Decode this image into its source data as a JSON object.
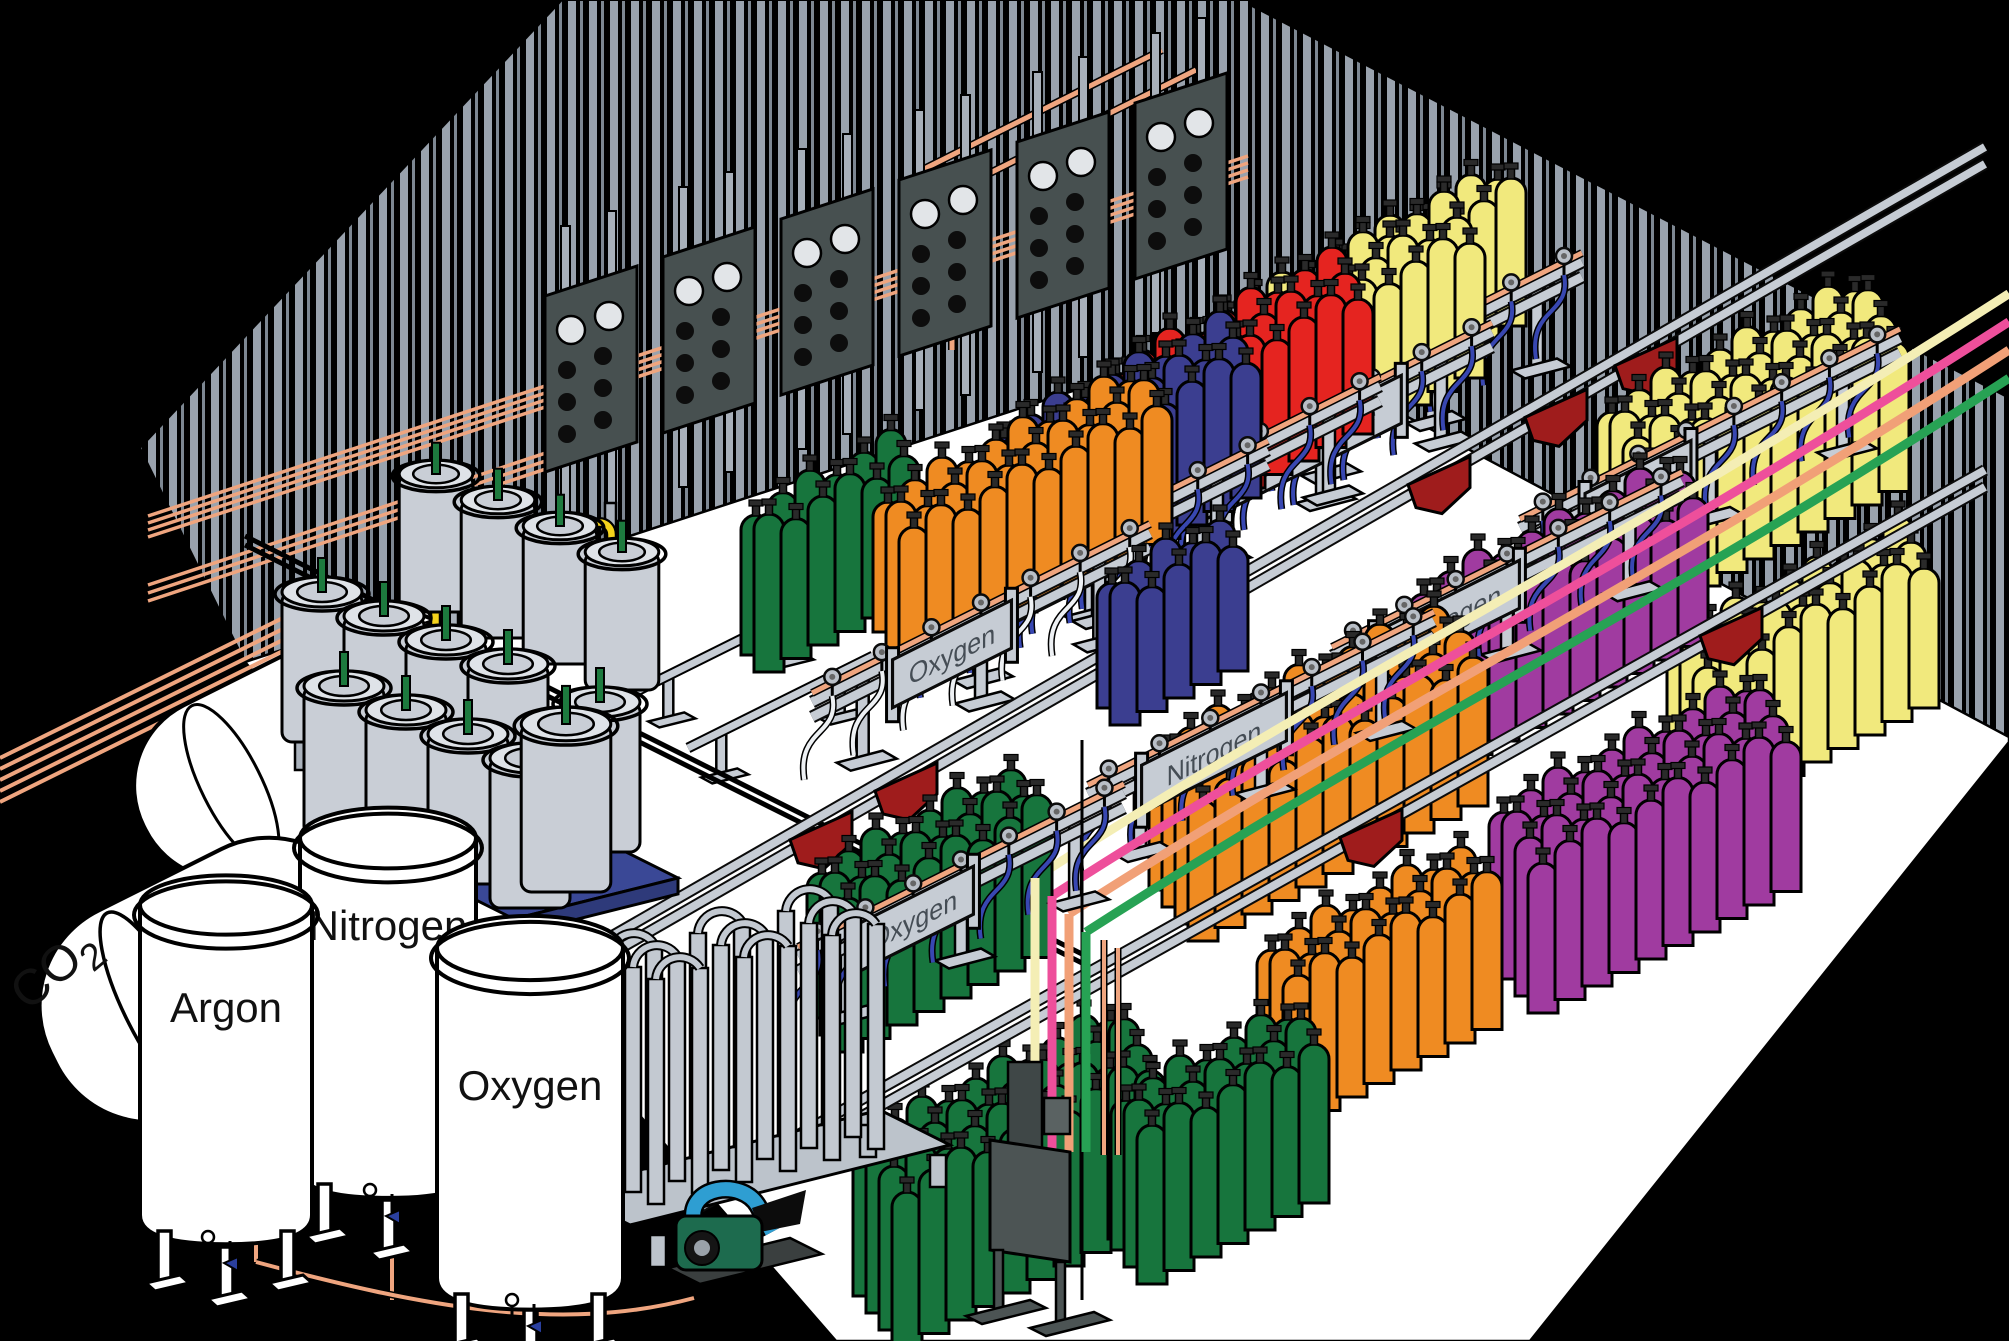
{
  "scene": {
    "description": "Isometric cutaway illustration of an industrial gas cylinder filling plant",
    "background": "#000000",
    "floor": "#ffffff",
    "wall_stripe": "#99a2ad"
  },
  "storage_tanks": [
    {
      "id": "co2",
      "label": "CO",
      "subscript": "2"
    },
    {
      "id": "argon",
      "label": "Argon"
    },
    {
      "id": "nitrogen",
      "label": "Nitrogen"
    },
    {
      "id": "oxygen",
      "label": "Oxygen"
    }
  ],
  "rack_signs": [
    {
      "id": "oxygen-back",
      "label": "Oxygen"
    },
    {
      "id": "nitrogen-back",
      "label": "Nitrogen"
    },
    {
      "id": "helium",
      "label": "Helium"
    },
    {
      "id": "carbon-dioxide",
      "label": "Carbon Dioxide"
    },
    {
      "id": "argon-back",
      "label": "Argon"
    },
    {
      "id": "argon-right",
      "label": "Argon"
    },
    {
      "id": "hydrogen",
      "label": "Hydrogen"
    },
    {
      "id": "nitrogen-front",
      "label": "Nitrogen"
    },
    {
      "id": "oxygen-front",
      "label": "Oxygen"
    }
  ],
  "cylinder_colors": {
    "oxygen": "#17753d",
    "nitrogen_blue": "#3b3e90",
    "helium": "#e52420",
    "carbon_dioxide": "#f1e97d",
    "argon": "#f1e97d",
    "hydrogen": "#a03ba0",
    "nitrogen_orange": "#ef8b22"
  },
  "pipe_colors": {
    "copper": "#efa57f",
    "hose_blue": "#3847b1",
    "hose_white": "#eef1f4",
    "pigtail_yellow": "#f4d31c",
    "line_cream": "#f4eeb5",
    "line_pink": "#ee4f9b",
    "line_salmon": "#f1a077",
    "line_green": "#27a254"
  },
  "equipment_colors": {
    "rack_gray": "#c6ccd4",
    "rail_dark": "#0b0b0b",
    "panel_dark": "#475050",
    "trolley_red": "#9f1c1c",
    "pallet_blue": "#3a4896",
    "dewar_gray": "#c9ced6",
    "valve_green": "#1d7a3e",
    "pump_teal": "#2e9ed2",
    "pump_green": "#1d6b4e",
    "indicator_red": "#cc2222"
  }
}
